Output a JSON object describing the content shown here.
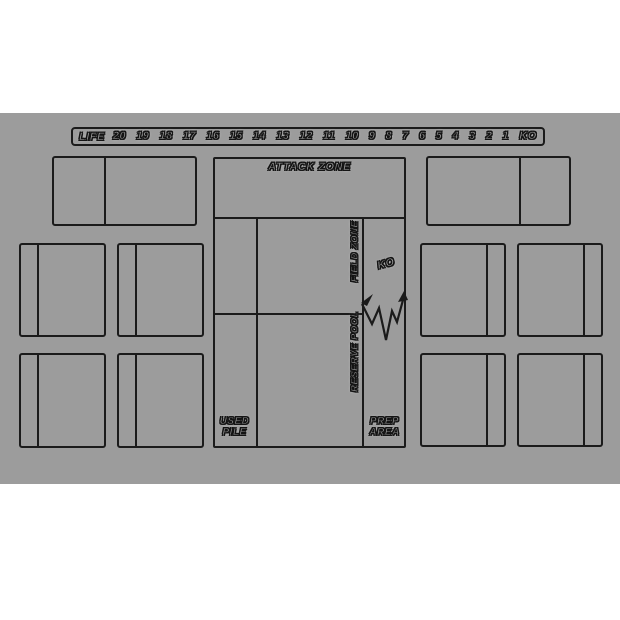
{
  "title": "Card game playmat",
  "colors": {
    "page_bg": "#ffffff",
    "mat_bg": "#9c9c9c",
    "line": "#1b1b1b",
    "text_fill": "#ababab"
  },
  "life_track": {
    "label": "LIFE",
    "values": [
      "20",
      "19",
      "18",
      "17",
      "16",
      "15",
      "14",
      "13",
      "12",
      "11",
      "10",
      "9",
      "8",
      "7",
      "6",
      "5",
      "4",
      "3",
      "2",
      "1",
      "KO"
    ]
  },
  "zones": {
    "attack_zone_label": "ATTACK ZONE",
    "field_zone_label": "FIELD ZONE",
    "reserve_pool_label": "RESERVE POOL",
    "ko_label": "KO",
    "used_pile_line1": "USED",
    "used_pile_line2": "PILE",
    "prep_area_line1": "PREP",
    "prep_area_line2": "AREA"
  }
}
